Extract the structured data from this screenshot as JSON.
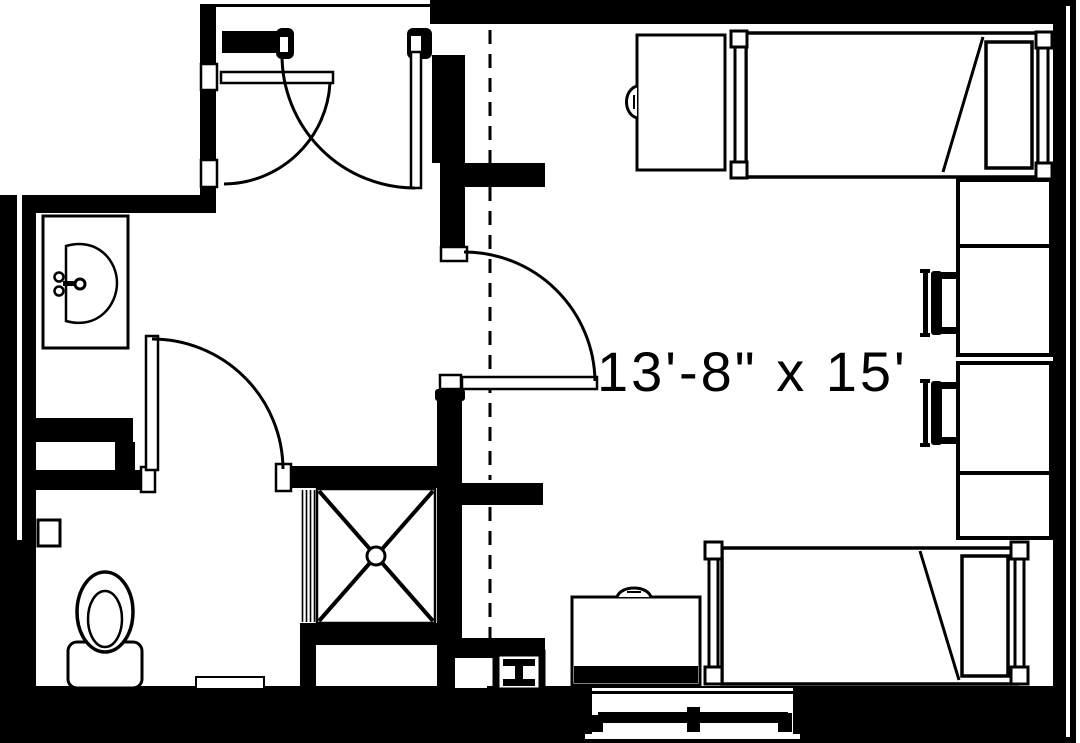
{
  "plan": {
    "room_label": "13'-8\" x 15'",
    "colors": {
      "line": "#000000",
      "background": "#ffffff"
    },
    "rooms": [
      "bedroom",
      "bathroom",
      "entry-vestibule"
    ],
    "elements": [
      "exterior-wall",
      "interior-wall",
      "entry-door",
      "closet-door",
      "bathroom-door",
      "bedroom-door",
      "sink-vanity",
      "faucet",
      "toilet",
      "toilet-paper-holder",
      "shower-with-drain",
      "steel-column",
      "window",
      "bed",
      "bed",
      "wardrobe",
      "desk-hutch",
      "desk-hutch",
      "desk-chair",
      "desk-chair",
      "desk",
      "bath-mat",
      "ceiling-break-dashed-line"
    ]
  }
}
